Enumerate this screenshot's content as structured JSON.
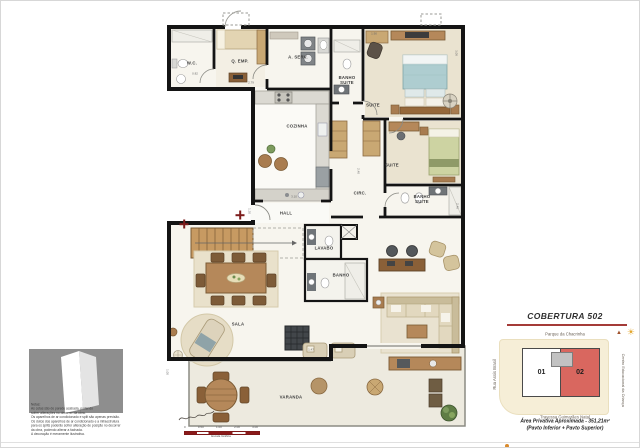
{
  "colors": {
    "wall": "#141414",
    "accent_red": "#a43b38",
    "unit_highlight": "#d9675f",
    "scalebar_red": "#8b1a1a",
    "wood": "#b5885a",
    "logo_gray": "#8e8e8e"
  },
  "floorplan": {
    "rooms": [
      {
        "name": "wc",
        "label": "W.C.",
        "x": 191,
        "y": 62
      },
      {
        "name": "q-emp",
        "label": "Q. EMP.",
        "x": 239,
        "y": 60
      },
      {
        "name": "a-serv",
        "label": "A. SERV.",
        "x": 297,
        "y": 56
      },
      {
        "name": "banho-suite-1",
        "label": "BANHO\nSUITE",
        "x": 346,
        "y": 79
      },
      {
        "name": "cozinha",
        "label": "COZINHA",
        "x": 296,
        "y": 125
      },
      {
        "name": "suite-1",
        "label": "SUITE",
        "x": 372,
        "y": 104
      },
      {
        "name": "suite-2",
        "label": "SUITE",
        "x": 391,
        "y": 164
      },
      {
        "name": "circ",
        "label": "CIRC.",
        "x": 359,
        "y": 192
      },
      {
        "name": "banho-suite-2",
        "label": "BANHO\nSUITE",
        "x": 421,
        "y": 198
      },
      {
        "name": "hall",
        "label": "HALL",
        "x": 285,
        "y": 212
      },
      {
        "name": "lavabo",
        "label": "LAVABO",
        "x": 323,
        "y": 247
      },
      {
        "name": "banho",
        "label": "BANHO",
        "x": 340,
        "y": 274
      },
      {
        "name": "sala",
        "label": "SALA",
        "x": 237,
        "y": 323
      },
      {
        "name": "varanda",
        "label": "VARANDA",
        "x": 290,
        "y": 396
      }
    ],
    "dimensions": [
      {
        "t": "0.82",
        "x": 194,
        "y": 73,
        "r": 0
      },
      {
        "t": "2.79",
        "x": 250,
        "y": 82,
        "r": 0
      },
      {
        "t": "1.90",
        "x": 373,
        "y": 33,
        "r": 0
      },
      {
        "t": "3.08",
        "x": 455,
        "y": 52,
        "r": 90
      },
      {
        "t": "3.10",
        "x": 293,
        "y": 196,
        "r": 0
      },
      {
        "t": "2.40",
        "x": 357,
        "y": 170,
        "r": 90
      },
      {
        "t": "2.48",
        "x": 456,
        "y": 205,
        "r": 90
      },
      {
        "t": "1.30",
        "x": 248,
        "y": 210,
        "r": 90
      },
      {
        "t": "1.47",
        "x": 310,
        "y": 349,
        "r": 0
      },
      {
        "t": "1.00",
        "x": 166,
        "y": 371,
        "r": 90
      }
    ],
    "markers": [
      {
        "x": 183,
        "y": 223
      },
      {
        "x": 239,
        "y": 214
      }
    ],
    "scalebar": {
      "ticks": [
        "0",
        "0.50",
        "1.00",
        "2.00",
        "3.00"
      ],
      "label": "Escala Gráfica"
    }
  },
  "notes": {
    "lines": [
      "Notas:",
      "As cotas são de parede acabada, podendo",
      "sofrer alterações no decorrer da obra.",
      "Os aparelhos de ar condicionado e split são apenas previsão.",
      "Os dutos dos aparelhos de ar condicionado e a infraestrutura",
      "para os splits poderão sofrer alteração de posição no decorrer",
      "da obra, podendo alterar a fachada.",
      "A decoração é meramente ilustrativa."
    ]
  },
  "keyplan": {
    "title": "COBERTURA 502",
    "sun_glyph": "☀",
    "north_glyph": "▲",
    "street_top": "Parque da Chacrinha",
    "street_left": "Rua Assis Brasil",
    "street_right": "Centro Educacional da Criança",
    "street_bottom": "Travessa Guimarães Natal",
    "unit_1": "01",
    "unit_2": "02",
    "area_line_1": "Área Privativa Aproximada  -  351,21m²",
    "area_line_2": "(Pavto Inferior + Pavto Superior)"
  }
}
